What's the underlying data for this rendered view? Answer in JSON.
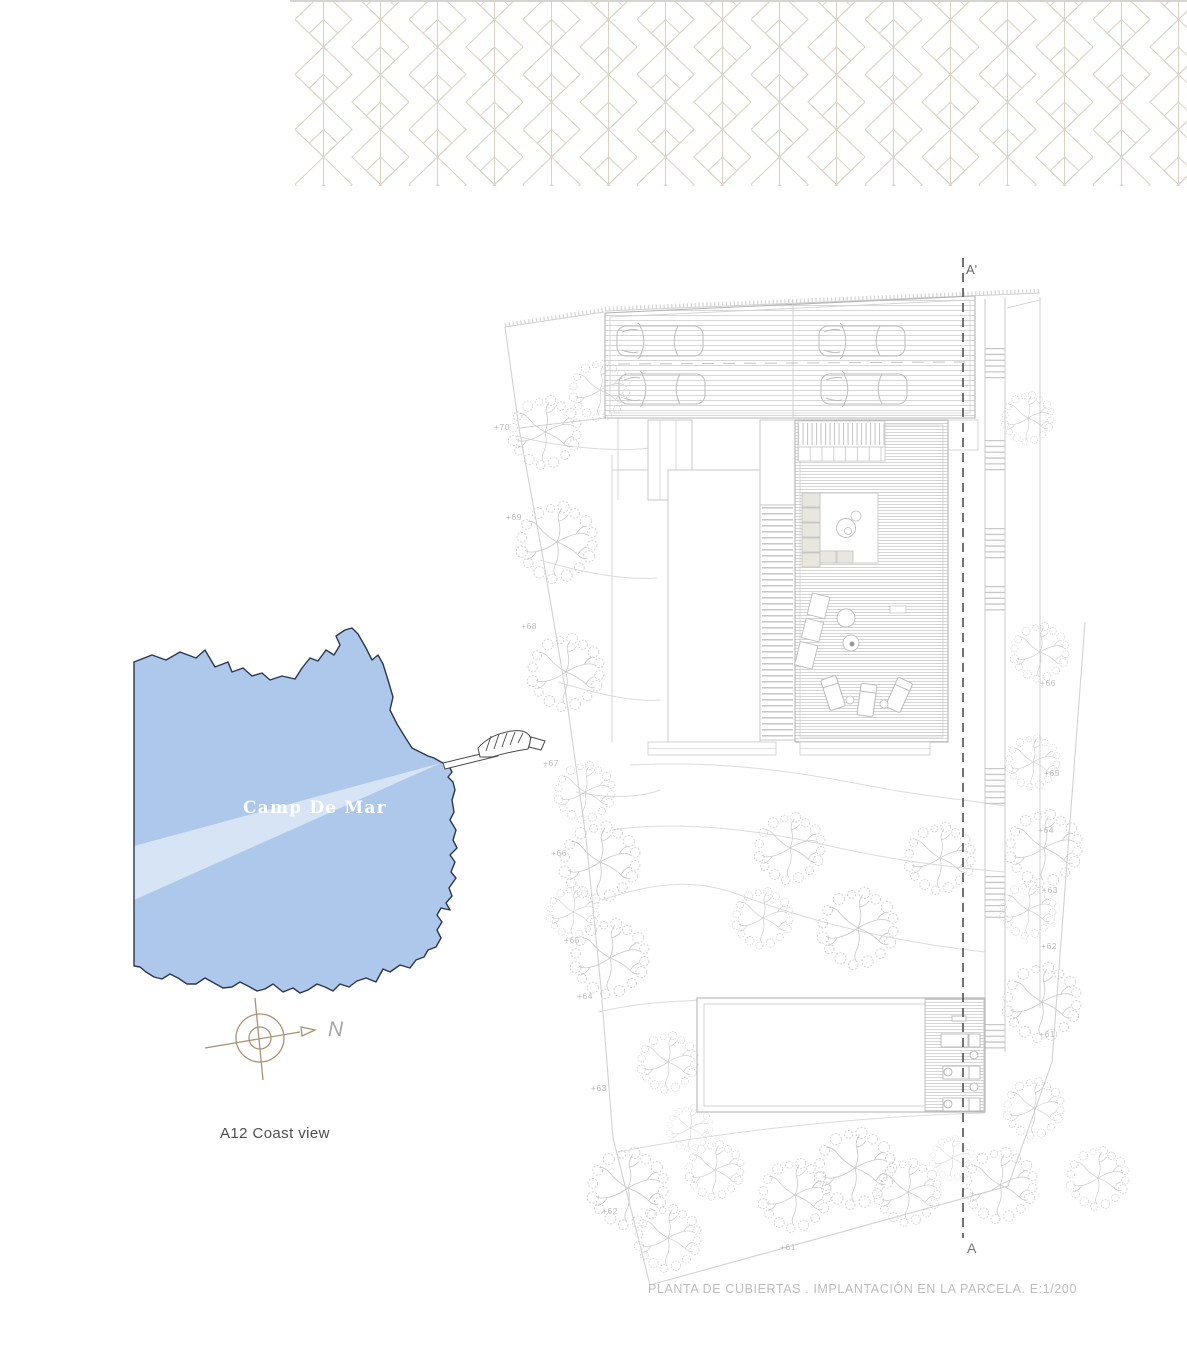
{
  "pattern": {
    "color": "#d9d1c3"
  },
  "map": {
    "label": "Camp De Mar",
    "water_color": "#adc8ea",
    "outline_color": "#2b3650"
  },
  "compass": {
    "north_label": "N",
    "color": "#ab9273"
  },
  "view_title": {
    "label": "A12 Coast view"
  },
  "plan": {
    "section_top_label": "A'",
    "section_bottom_label": "A",
    "elevations_left": [
      "+70",
      "+69",
      "+68",
      "+67",
      "+66",
      "+65",
      "+64",
      "+63",
      "+62"
    ],
    "elevations_right": [
      "+66",
      "+65",
      "+64",
      "+63",
      "+62",
      "+61"
    ],
    "elevation_bottom": "+61",
    "caption": "PLANTA DE CUBIERTAS . IMPLANTACIÓN EN LA PARCELA. E:1/200"
  }
}
